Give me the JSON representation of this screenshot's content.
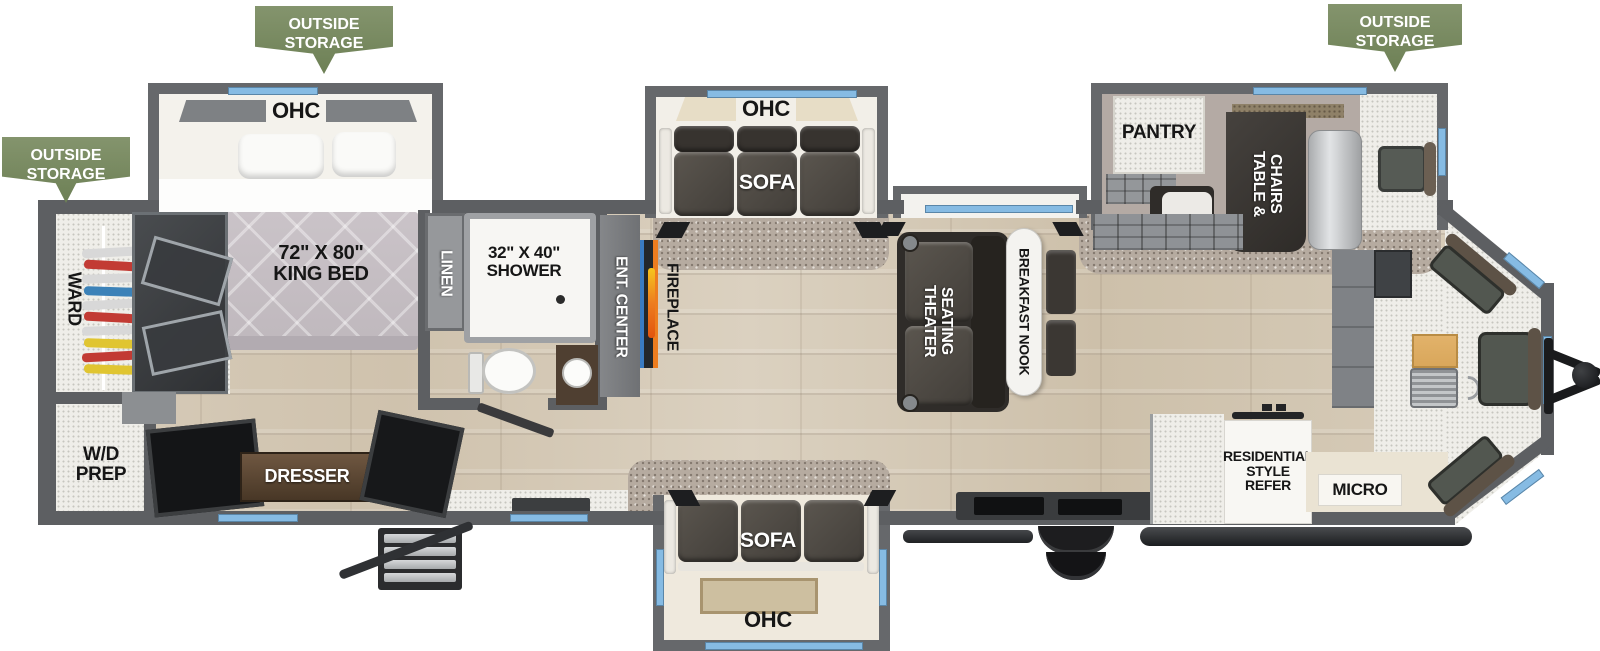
{
  "badges": {
    "outside_storage": "OUTSIDE\nSTORAGE"
  },
  "bedroom": {
    "ohc": "OHC",
    "king_bed": "72\" X 80\"\nKING BED",
    "ward": "WARD",
    "wd_prep": "W/D\nPREP",
    "dresser": "DRESSER"
  },
  "bathroom": {
    "linen": "LINEN",
    "shower": "32\" X 40\"\nSHOWER"
  },
  "living": {
    "ent_center": "ENT. CENTER",
    "fireplace": "FIREPLACE",
    "theater_seating": "THEATER\nSEATING",
    "breakfast_nook": "BREAKFAST NOOK",
    "sofa_top": {
      "ohc": "OHC",
      "sofa": "SOFA"
    },
    "sofa_bottom": {
      "ohc": "OHC",
      "sofa": "SOFA"
    }
  },
  "kitchen": {
    "pantry": "PANTRY",
    "table_chairs": "TABLE &\nCHAIRS",
    "refer": "RESIDENTIAL\nSTYLE\nREFER",
    "micro": "MICRO"
  },
  "colors": {
    "badge_green": "#7d9164",
    "window_blue": "#86BBE3",
    "wall_gray": "#5d5f62",
    "flame_orange": "#ED7D1F",
    "fireplace_blue": "#3A7BC2"
  }
}
